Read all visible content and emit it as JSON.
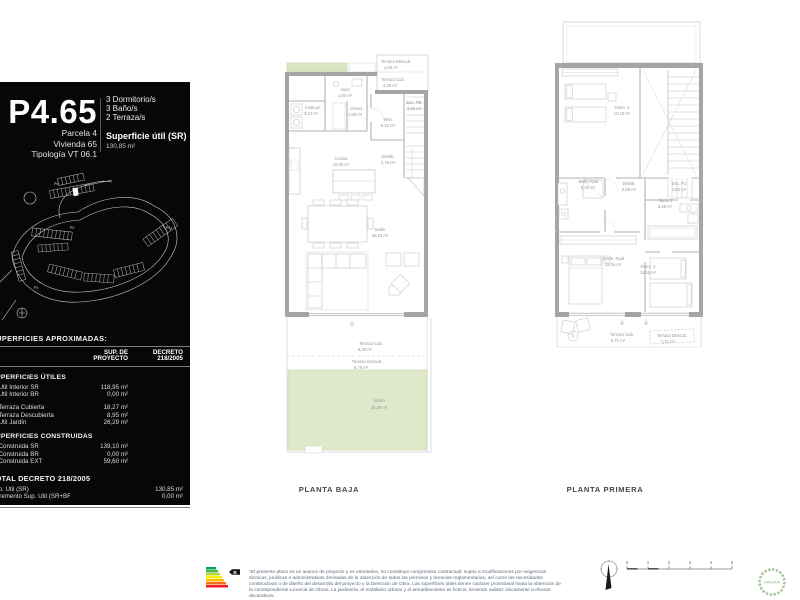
{
  "panel": {
    "unit_code": "P4.65",
    "sub_lines": [
      "Parcela 4",
      "Vivienda 65",
      "Tipología VT 06.1"
    ],
    "features": [
      "3 Dormitorio/s",
      "3 Baño/s",
      "2 Terraza/s"
    ],
    "superficie_label": "Superficie útil (SR)",
    "superficie_value": "130,85 m²",
    "siteplan_labels": {
      "p4": "P4",
      "p2": "P2",
      "p11": "P11",
      "p3": "P3"
    },
    "table": {
      "title": "SUPERFICIES APROXIMADAS:",
      "col1_header": "SUP. DE PROYECTO",
      "col2_header": "DECRETO 218/2005",
      "sections": [
        {
          "heading": "SUPERFICIES ÚTILES",
          "rows": [
            {
              "label": "S. Útil Interior SR",
              "v1": "118,95 m²",
              "v2": ""
            },
            {
              "label": "S. Útil Interior BR",
              "v1": "0,00 m²",
              "v2": ""
            },
            {
              "label": "S. Terraza Cubierta",
              "v1": "18,27 m²",
              "v2": ""
            },
            {
              "label": "S. Terraza Descubierta",
              "v1": "8,95 m²",
              "v2": ""
            },
            {
              "label": "S. Útil Jardín",
              "v1": "26,29 m²",
              "v2": ""
            }
          ]
        },
        {
          "heading": "SUPERFICIES CONSTRUIDAS",
          "rows": [
            {
              "label": "S. Construida SR",
              "v1": "139,10 m²",
              "v2": ""
            },
            {
              "label": "S. Construida BR",
              "v1": "0,00 m²",
              "v2": ""
            },
            {
              "label": "S. Construida EXT",
              "v1": "59,60 m²",
              "v2": ""
            }
          ]
        },
        {
          "heading": "TOTAL DECRETO 218/2005",
          "rows": [
            {
              "label": "Sup. Útil (SR)",
              "v1": "",
              "v2": "130,85 m²"
            },
            {
              "label": "Incremento Sup. Útil (SR+BR)",
              "v1": "",
              "v2": "0,00 m²"
            }
          ]
        }
      ]
    }
  },
  "planta_baja": {
    "title": "PLANTA BAJA",
    "rooms": [
      {
        "name": "Terraza Descub.",
        "area": "1,49 m²"
      },
      {
        "name": "Terraza Cub.",
        "area": "3,26 m²"
      },
      {
        "name": "Aseo",
        "area": "1,94 m²"
      },
      {
        "name": "Inst/Lav.",
        "area": "3,24 m²"
      },
      {
        "name": "Closet",
        "area": "1,69 m²"
      },
      {
        "name": "Vest.",
        "area": "6,22 m²"
      },
      {
        "name": "Esc. PB",
        "area": "3,00 m²"
      },
      {
        "name": "Cocina",
        "area": "10,06 m²"
      },
      {
        "name": "Distrib.",
        "area": "2,76 m²"
      },
      {
        "name": "Salón",
        "area": "29,23 m²"
      },
      {
        "name": "Terraza Cub.",
        "area": "8,30 m²"
      },
      {
        "name": "Terraza Descub.",
        "area": "5,76 m²"
      },
      {
        "name": "Jardín",
        "area": "26,29 m²"
      }
    ]
  },
  "planta_primera": {
    "title": "PLANTA PRIMERA",
    "rooms": [
      {
        "name": "Dorm. 2",
        "area": "10,16 m²"
      },
      {
        "name": "Baño Ppal.",
        "area": "5,06 m²"
      },
      {
        "name": "Distrib.",
        "area": "2,96 m²"
      },
      {
        "name": "Esc. P1",
        "area": "1,62 m²"
      },
      {
        "name": "Baño 2",
        "area": "3,46 m²"
      },
      {
        "name": "Dorm. Ppal.",
        "area": "15,06 m²"
      },
      {
        "name": "Dorm. 3",
        "area": "11,55 m²"
      },
      {
        "name": "Terraza Cub.",
        "area": "9,71 m²"
      },
      {
        "name": "Terraza Descub.",
        "area": "1,21 m²"
      }
    ]
  },
  "footer": {
    "disclaimer": "*El presente plano es un avance de proyecto y es orientativo, no constituye compromiso contractual; sujeto a modificaciones por exigencias técnicas, jurídicas o administrativas derivadas de la obtención de todos los permisos y licencias reglamentarias, así como las necesidades constructivas o de diseño del desarrollo del proyecto y la Dirección de Obra. Las superficies útiles tienen carácter provisional hasta la obtención de la correspondiente Licencia de Obras. La jardinería, el mobiliario urbano y el amueblamiento es ficticio, teniendo validez únicamente a efectos decorativos.",
    "energy_arrow_label": "B",
    "scale_ticks": [
      "0",
      "1",
      "2",
      "3",
      "4",
      "5"
    ],
    "breeam_label": "BREEAM"
  }
}
